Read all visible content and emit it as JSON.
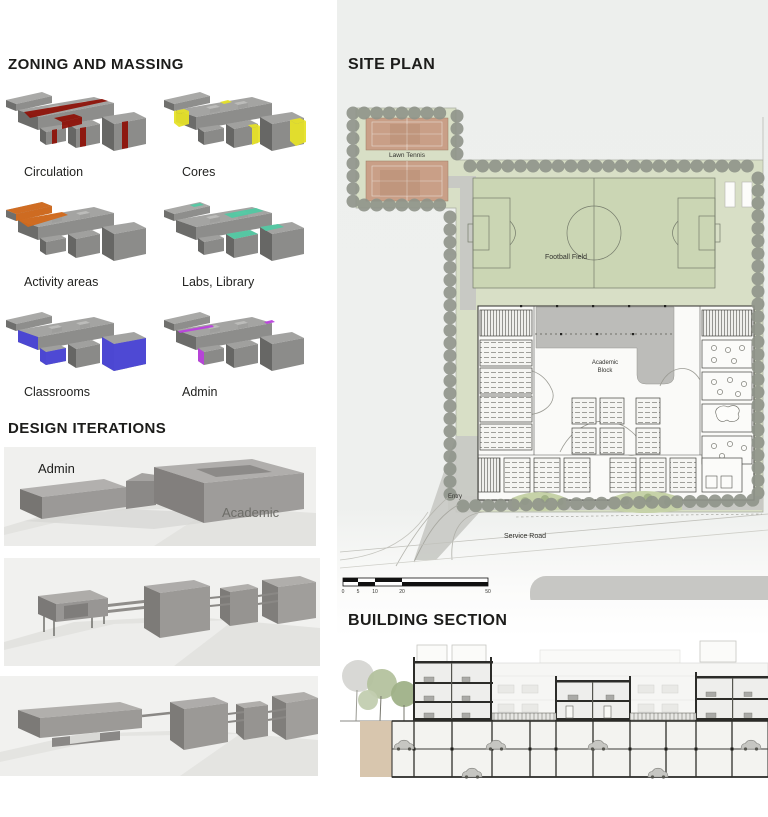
{
  "zoning": {
    "title": "ZONING AND MASSING",
    "items": [
      {
        "label": "Circulation",
        "color": "#8E1309"
      },
      {
        "label": "Cores",
        "color": "#E6E128"
      },
      {
        "label": "Activity areas",
        "color": "#D2691B"
      },
      {
        "label": "Labs, Library",
        "color": "#52C9A3"
      },
      {
        "label": "Classrooms",
        "color": "#4B46D8"
      },
      {
        "label": "Admin",
        "color": "#BB42DD"
      }
    ]
  },
  "iterations": {
    "title": "DESIGN ITERATIONS",
    "model1": {
      "admin_label": "Admin",
      "academic_label": "Academic"
    }
  },
  "site_plan": {
    "title": "SITE PLAN",
    "labels": {
      "lawn_tennis": "Lawn Tennis",
      "football_field": "Football Field",
      "academic_block_line1": "Academic",
      "academic_block_line2": "Block",
      "entry": "Entry",
      "service_road": "Service Road"
    },
    "scale_bar": {
      "ticks": [
        "0",
        "5",
        "10",
        "20",
        "50"
      ]
    },
    "colors": {
      "site_green": "#D8DFC6",
      "field_green": "#CBD6B4",
      "tennis_court": "#C99F87",
      "tree": "#8F948A",
      "path": "#C8C9C4",
      "roof": "#B7B7B4"
    }
  },
  "section": {
    "title": "BUILDING SECTION"
  }
}
